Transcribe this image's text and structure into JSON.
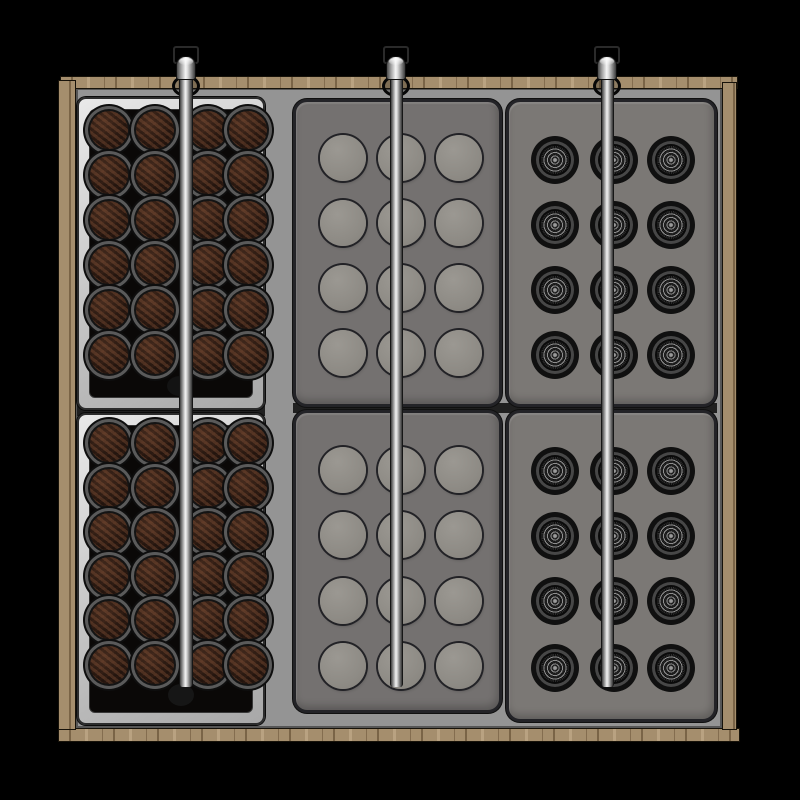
{
  "scene": {
    "description": "Top-down 3D render of a wooden drawer insert holding six capsule trays and three steel support rods on a black background",
    "colors": {
      "background": "#000000",
      "wood_base": "#a58e6d",
      "wood_outline": "#171209",
      "floor_gray": "#949494",
      "tray_silver": "#d6d6d6",
      "tray_face_black": "#0a0807",
      "capsule_brown": "#2e1d15",
      "capsule_ring_gray": "#5a5a5a",
      "tray_gray_mid": "#747170",
      "tray_gray_right": "#7b7875",
      "well_gray": "#929089",
      "mesh_dark": "#0d0d0d",
      "mesh_ring": "#474747",
      "rod_highlight": "#f2f2f2",
      "rod_shadow": "#3a3a3a"
    },
    "frame": {
      "top": {
        "x": 60,
        "y": 76,
        "w": 678,
        "h": 13
      },
      "bottom": {
        "x": 58,
        "y": 728,
        "w": 682,
        "h": 14
      },
      "left": {
        "x": 58,
        "y": 80,
        "w": 18,
        "h": 650
      },
      "right": {
        "x": 722,
        "y": 82,
        "w": 15,
        "h": 648
      },
      "floor": {
        "x": 76,
        "y": 88,
        "w": 646,
        "h": 640
      }
    },
    "seams": [
      {
        "name": "tray-seam-left-column",
        "x": 77,
        "y": 404,
        "w": 188,
        "h": 12
      },
      {
        "name": "tray-seam-right-columns",
        "x": 293,
        "y": 403,
        "w": 424,
        "h": 10
      }
    ],
    "trays": [
      {
        "name": "capsule-tray-top-left",
        "type": "capsule",
        "x": 77,
        "y": 97,
        "w": 188,
        "h": 313,
        "cols": [
          29,
          75,
          128,
          168
        ],
        "rows": [
          30,
          75,
          120,
          165,
          210,
          255
        ],
        "pod_d": 38
      },
      {
        "name": "capsule-tray-bottom-left",
        "type": "capsule",
        "x": 77,
        "y": 413,
        "w": 188,
        "h": 312,
        "cols": [
          29,
          75,
          128,
          168
        ],
        "rows": [
          27,
          72,
          116,
          160,
          204,
          249
        ],
        "pod_d": 38
      },
      {
        "name": "well-tray-top-middle",
        "type": "well",
        "x": 293,
        "y": 99,
        "w": 209,
        "h": 308,
        "cols": [
          47,
          105,
          163
        ],
        "rows": [
          56,
          121,
          186,
          251
        ],
        "pod_d": 46
      },
      {
        "name": "well-tray-bottom-middle",
        "type": "well",
        "x": 293,
        "y": 410,
        "w": 209,
        "h": 303,
        "cols": [
          47,
          105,
          163
        ],
        "rows": [
          57,
          122,
          188,
          253
        ],
        "pod_d": 46
      },
      {
        "name": "mesh-tray-top-right",
        "type": "mesh",
        "x": 506,
        "y": 99,
        "w": 211,
        "h": 308,
        "cols": [
          46,
          105,
          162
        ],
        "rows": [
          58,
          123,
          188,
          253
        ],
        "pod_d": 28
      },
      {
        "name": "mesh-tray-bottom-right",
        "type": "mesh",
        "x": 506,
        "y": 410,
        "w": 211,
        "h": 312,
        "cols": [
          46,
          105,
          162
        ],
        "rows": [
          58,
          123,
          188,
          255
        ],
        "pod_d": 28
      }
    ],
    "rods": [
      {
        "name": "rod-left",
        "cx": 186,
        "shaft_w": 14,
        "bracket_y": 46,
        "cap_y": 56,
        "shaft_top": 64,
        "shaft_bottom": 687,
        "hole_cy": 86,
        "mid_hole": {
          "cx": 180,
          "cy": 386
        },
        "bottom_hole": {
          "cx": 181,
          "cy": 695
        }
      },
      {
        "name": "rod-middle",
        "cx": 396,
        "shaft_w": 13,
        "bracket_y": 46,
        "cap_y": 56,
        "shaft_top": 64,
        "shaft_bottom": 687,
        "hole_cy": 86
      },
      {
        "name": "rod-right",
        "cx": 607,
        "shaft_w": 13,
        "bracket_y": 46,
        "cap_y": 56,
        "shaft_top": 64,
        "shaft_bottom": 687,
        "hole_cy": 86
      }
    ],
    "object_inventory": {
      "trays": 6,
      "rods": 3,
      "brown_capsules": 48,
      "empty_wells": 24,
      "mesh_capsules": 24
    }
  }
}
